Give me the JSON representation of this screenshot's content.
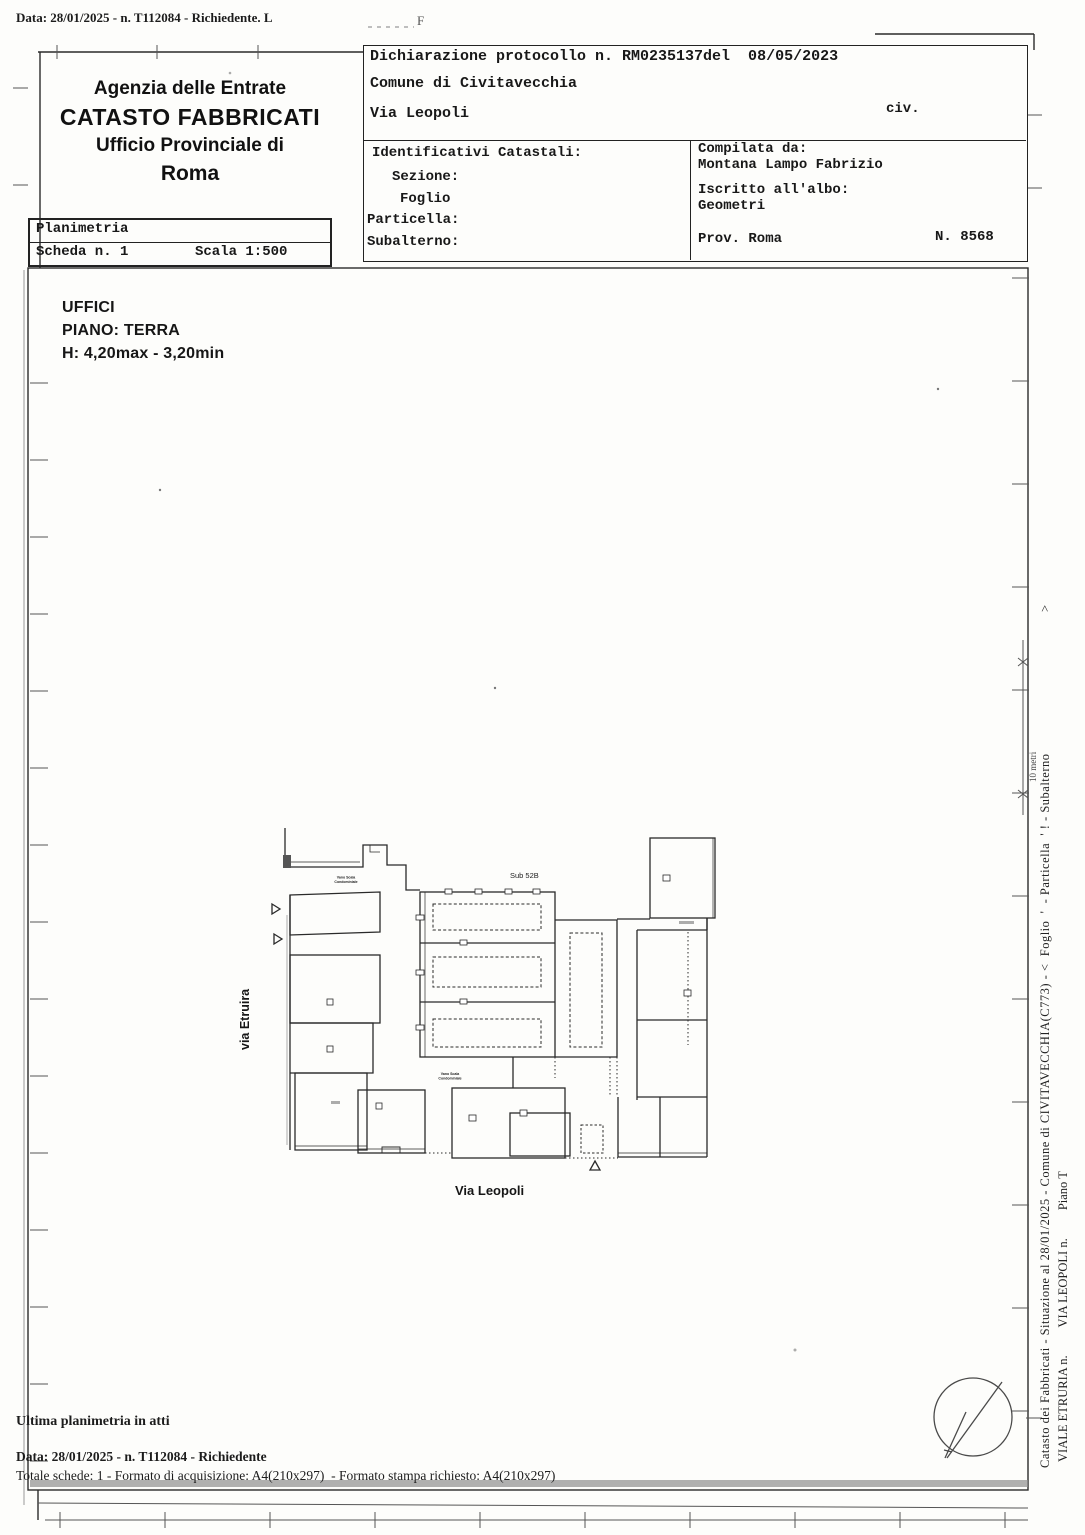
{
  "document": {
    "top_margin_line": "Data: 28/01/2025 - n. T112084 - Richiedente. L",
    "faint_mark": "F"
  },
  "header": {
    "agency_line1": "Agenzia delle Entrate",
    "agency_line2": "CATASTO FABBRICATI",
    "agency_line3": "Ufficio Provinciale di",
    "agency_line4": "Roma",
    "planimetria_label": "Planimetria",
    "scheda_label": "Scheda n. 1",
    "scala_label": "Scala 1:500",
    "protocol_line": "Dichiarazione protocollo n. RM0235137del  08/05/2023",
    "comune_line": "Comune di Civitavecchia",
    "street_line": "Via Leopoli",
    "civ_label": "civ.",
    "catastali_title": "Identificativi Catastali:",
    "sezione_label": "Sezione:",
    "foglio_label": "Foglio",
    "particella_label": "Particella:",
    "subalterno_label": "Subalterno:",
    "compilata_label": "Compilata da:",
    "compilata_name": "Montana Lampo Fabrizio",
    "albo_label": "Iscritto all'albo:",
    "albo_value": "Geometri",
    "prov_label": "Prov. Roma",
    "albo_number": "N. 8568"
  },
  "drawing": {
    "dest_line1": "UFFICI",
    "dest_line2": "PIANO: TERRA",
    "dest_line3": "H: 4,20max - 3,20min",
    "sub_label": "Sub 52B",
    "street_left": "via Etruira",
    "street_bottom": "Via Leopoli",
    "stair_label_line1": "Vano Scala",
    "stair_label_line2": "Condominiale",
    "scale_label": "10 metri"
  },
  "sidebar": {
    "info_line": "Catasto dei Fabbricati - Situazione al 28/01/2025 - Comune di CIVITAVECCHIA(C773) - <  Foglio  '  - Particella  ' ! - Subalterno",
    "info_line_end": ">",
    "address_line": "VIALE ETRURIA n.         VIA LEOPOLI n.         Piano T"
  },
  "footer": {
    "ultima_line": "Ultima planimetria in atti",
    "data_line": "Data: 28/01/2025 - n. T112084 - Richiedente",
    "totale_line": "Totale schede: 1 - Formato di acquisizione: A4(210x297)  - Formato stampa richiesto: A4(210x297)"
  }
}
